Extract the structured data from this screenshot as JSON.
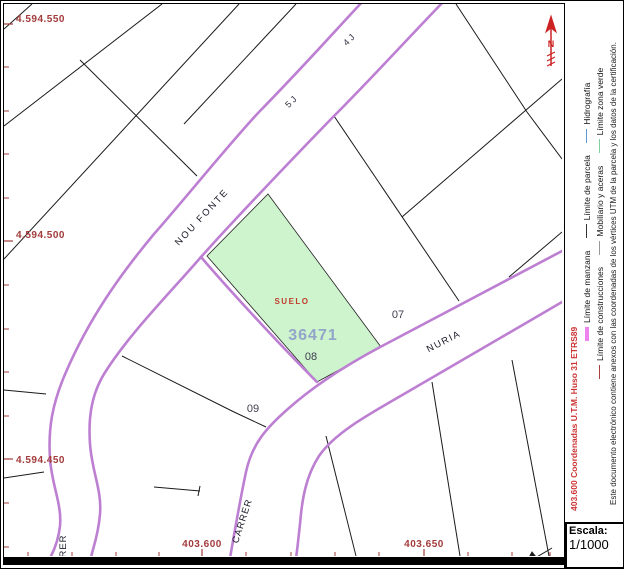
{
  "map": {
    "axis": {
      "y_labels": [
        {
          "text": "4.594.550"
        },
        {
          "text": "4.594.500"
        },
        {
          "text": "4.594.450"
        }
      ],
      "x_labels": [
        {
          "text": "403.600"
        },
        {
          "text": "403.650"
        }
      ]
    },
    "parcel": {
      "suelo": "SUELO",
      "number": "36471"
    },
    "parcel_numbers": [
      {
        "text": "07"
      },
      {
        "text": "08"
      },
      {
        "text": "09"
      }
    ],
    "street_labels": [
      {
        "text": "NOU FONTE"
      },
      {
        "text": "NURIA"
      },
      {
        "text": "CARRER"
      },
      {
        "text": "RER"
      },
      {
        "text": "4 J"
      },
      {
        "text": "5 J"
      }
    ],
    "north": "N"
  },
  "sidebar": {
    "coords_note": "403.600 Coordenadas U.T.M. Huso 31 ETRS89",
    "legend_row1": [
      {
        "label": "Límite de manzana"
      },
      {
        "label": "Límite de parcela"
      },
      {
        "label": "Hidrografía"
      }
    ],
    "legend_row2": [
      {
        "label": "Límite de construcciones"
      },
      {
        "label": "Mobiliario y aceras"
      },
      {
        "label": "Límite zona verde"
      }
    ],
    "disclaimer": "Este documento electrónico contiene anexos con las coordenadas de los vértices UTM de la parcela y los datos de la certificación."
  },
  "scale": {
    "label": "Escala:",
    "value": "1/1000"
  },
  "colors": {
    "road": "#bd7fd2",
    "parcel_fill": "#cdf4cd",
    "parcel_number_text": "#93a5c9",
    "suelo_text": "#c23b2e",
    "coord_red": "#a33b3b",
    "manzana": "#ee82ee",
    "parcela": "#333333",
    "hidrografia": "#5b9bd5",
    "construcciones": "#aa4040",
    "mobiliario": "#999999",
    "zona_verde": "#7fcf9f",
    "north_arrow": "#cc2222"
  }
}
